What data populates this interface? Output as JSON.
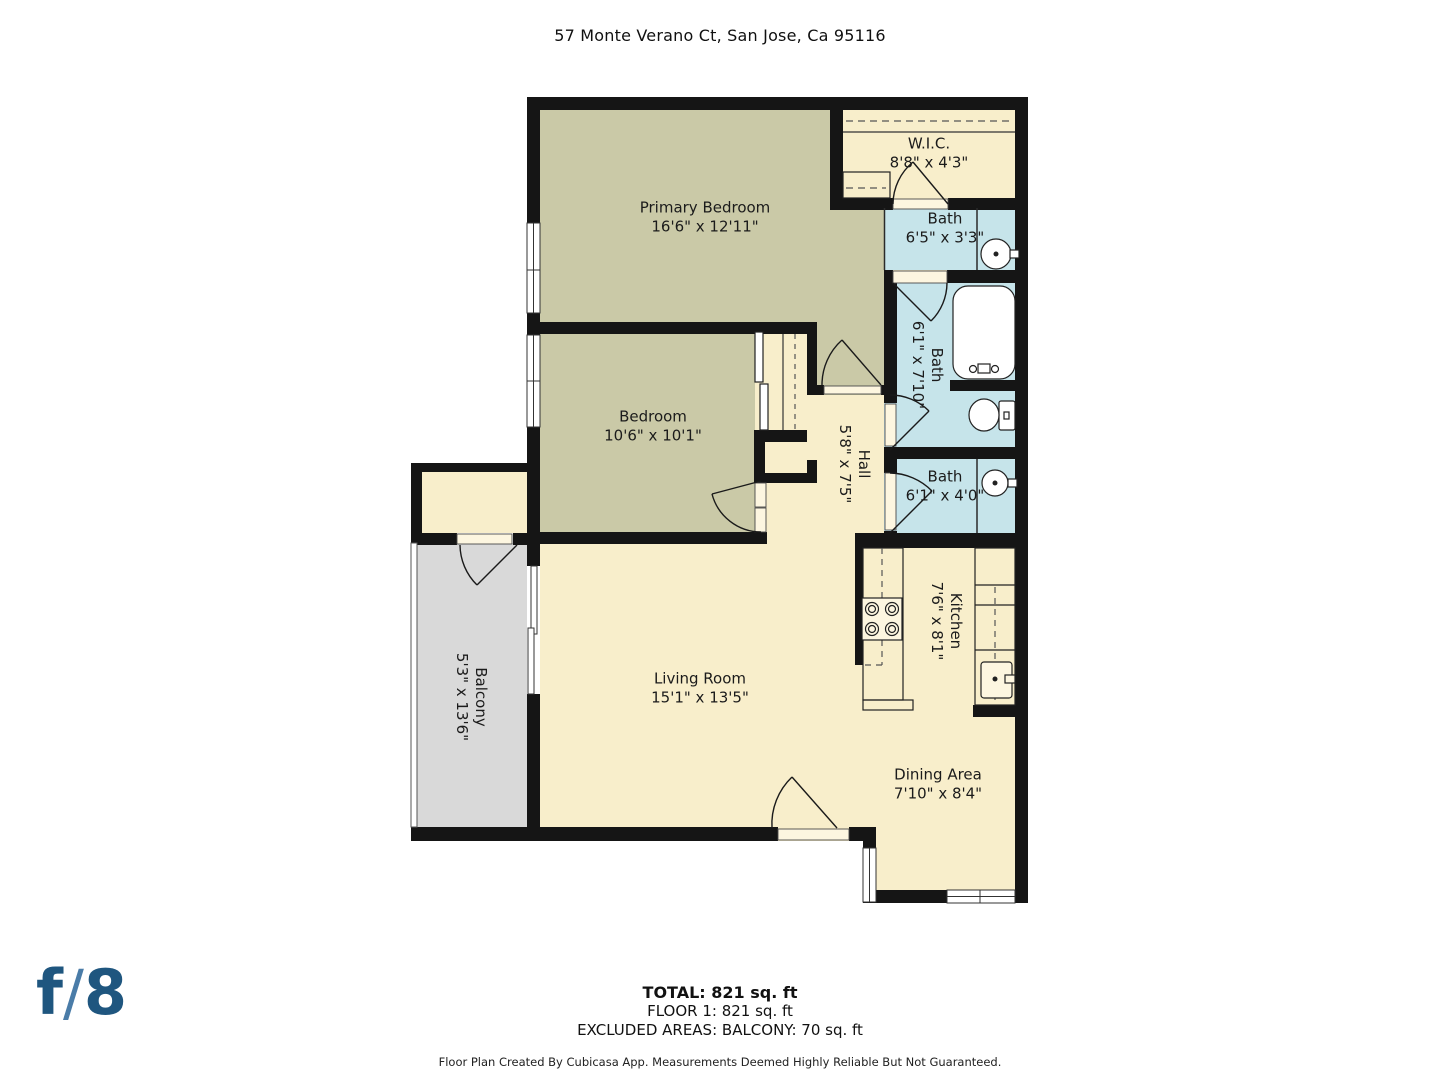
{
  "palette": {
    "wall": "#151515",
    "sage": "#cac9a7",
    "cream": "#f8eecb",
    "blue": "#c6e4ea",
    "gray": "#d9d9d9",
    "logo": "#1f567f",
    "logoSlash": "#4a7ca8"
  },
  "header": {
    "title": "57 Monte Verano Ct, San Jose, Ca 95116"
  },
  "rooms": [
    {
      "name": "Primary Bedroom",
      "dims": "16'6\" x 12'11\""
    },
    {
      "name": "W.I.C.",
      "dims": "8'8\" x 4'3\""
    },
    {
      "name": "Bath",
      "dims": "6'5\" x 3'3\""
    },
    {
      "name": "Bath",
      "dims": "6'1\" x 7'10\""
    },
    {
      "name": "Bath",
      "dims": "6'1\" x 4'0\""
    },
    {
      "name": "Bedroom",
      "dims": "10'6\" x 10'1\""
    },
    {
      "name": "Hall",
      "dims": "5'8\" x 7'5\""
    },
    {
      "name": "Kitchen",
      "dims": "7'6\" x 8'1\""
    },
    {
      "name": "Living Room",
      "dims": "15'1\" x 13'5\""
    },
    {
      "name": "Dining Area",
      "dims": "7'10\" x 8'4\""
    },
    {
      "name": "Balcony",
      "dims": "5'3\" x 13'6\""
    }
  ],
  "footer": {
    "total": "TOTAL: 821 sq. ft",
    "floor": "FLOOR 1: 821 sq. ft",
    "excluded": "EXCLUDED AREAS: BALCONY: 70 sq. ft",
    "disclaimer": "Floor Plan Created By Cubicasa App. Measurements Deemed Highly Reliable But Not Guaranteed."
  },
  "logo": {
    "f": "f",
    "slash": "/",
    "eight": "8"
  }
}
